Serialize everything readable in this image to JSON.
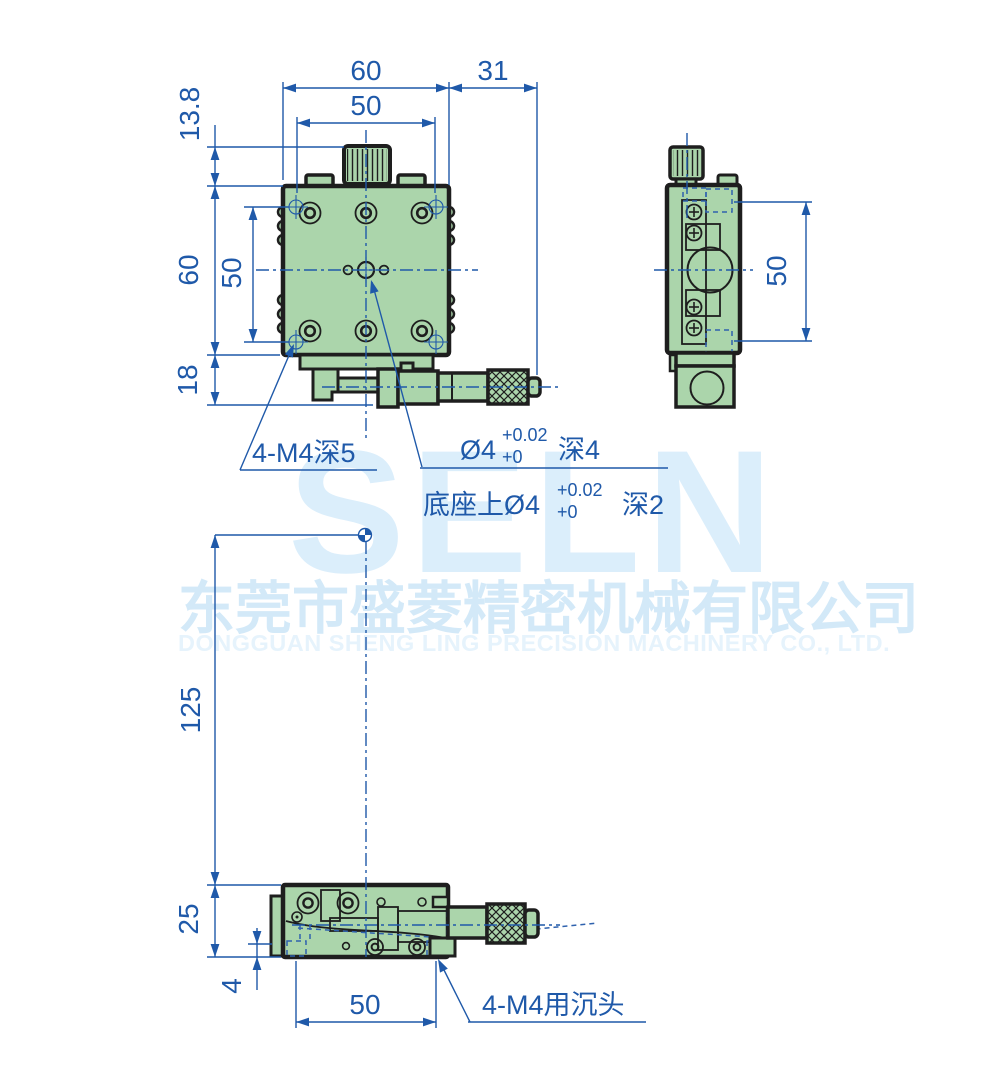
{
  "watermark": {
    "logo": "SELN",
    "company_cn": "东莞市盛菱精密机械有限公司",
    "company_en": "DONGGUAN SHENG LING PRECISION MACHINERY CO., LTD."
  },
  "colors": {
    "dimension_blue": "#1f59a9",
    "body_green": "#abd5ab",
    "outline_dark": "#1e1e1e",
    "watermark_blue": "#dbeefb"
  },
  "dims": {
    "top_outer_width": "60",
    "top_hole_span": "50",
    "micrometer_overhang": "31",
    "knob_height": "13.8",
    "left_outer_height": "60",
    "left_hole_span": "50",
    "foot_height": "18",
    "side_pocket_span": "50",
    "center_to_base": "125",
    "base_height": "25",
    "counterbore_offset": "4",
    "base_hole_span": "50"
  },
  "notes": {
    "corner_tapped_holes": "4-M4深5",
    "center_pin_hole": {
      "dia": "Ø4",
      "tol_up": "+0.02",
      "tol_low": "+0",
      "depth": "深4"
    },
    "base_pin_hole": {
      "prefix": "底座上Ø4",
      "tol_up": "+0.02",
      "tol_low": "+0",
      "depth": "深2"
    },
    "base_mount_holes": "4-M4用沉头"
  }
}
